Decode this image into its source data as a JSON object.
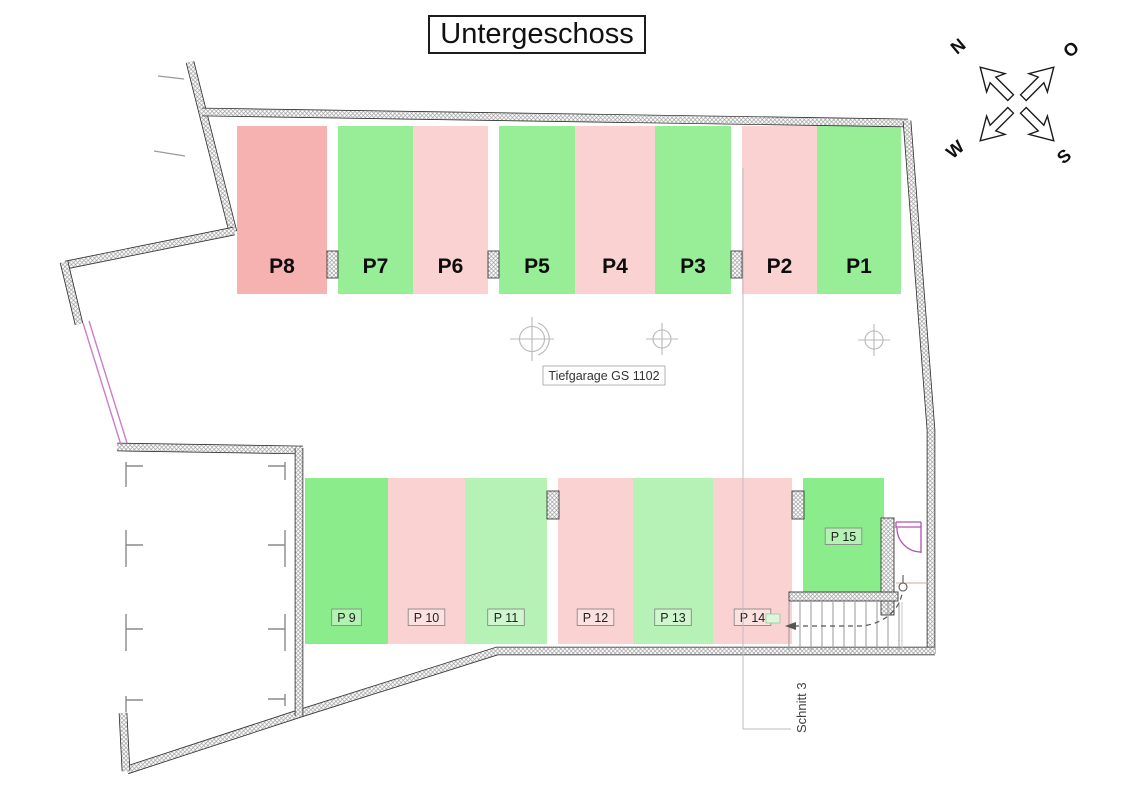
{
  "title": "Untergeschoss",
  "plan": {
    "garage_label": "Tiefgarage GS 1102",
    "section_label": "Schnitt 3"
  },
  "compass": {
    "north": "N",
    "east": "O",
    "west": "W",
    "south": "S"
  },
  "colors": {
    "pink": "#fbd2d2",
    "pink_dark": "#f6b1b1",
    "green": "#97ee97",
    "green_bright": "#8aec8a",
    "green_light": "#b6f2b6",
    "wall_line": "#9a9a9a",
    "magenta": "#b44fb4"
  },
  "parking": {
    "top_row": {
      "y": 126,
      "h": 168,
      "label_y": 273,
      "boxed": false,
      "spots": [
        {
          "label": "P8",
          "x": 237,
          "w": 90,
          "color": "pink_dark"
        },
        {
          "label": "P7",
          "x": 338,
          "w": 75,
          "color": "green"
        },
        {
          "label": "P6",
          "x": 413,
          "w": 75,
          "color": "pink"
        },
        {
          "label": "P5",
          "x": 499,
          "w": 76,
          "color": "green"
        },
        {
          "label": "P4",
          "x": 575,
          "w": 80,
          "color": "pink"
        },
        {
          "label": "P3",
          "x": 655,
          "w": 76,
          "color": "green"
        },
        {
          "label": "P2",
          "x": 742,
          "w": 75,
          "color": "pink"
        },
        {
          "label": "P1",
          "x": 817,
          "w": 84,
          "color": "green"
        }
      ]
    },
    "bottom_row": {
      "y": 478,
      "h": 166,
      "label_y": 622,
      "boxed": true,
      "spots": [
        {
          "label": "P 9",
          "x": 305,
          "w": 83,
          "color": "green_bright"
        },
        {
          "label": "P 10",
          "x": 388,
          "w": 77,
          "color": "pink"
        },
        {
          "label": "P 11",
          "x": 465,
          "w": 82,
          "color": "green_light"
        },
        {
          "label": "P 12",
          "x": 558,
          "w": 75,
          "color": "pink"
        },
        {
          "label": "P 13",
          "x": 633,
          "w": 80,
          "color": "green_light"
        },
        {
          "label": "P 14",
          "x": 713,
          "w": 79,
          "color": "pink"
        },
        {
          "label": "P 15",
          "x": 803,
          "w": 81,
          "color": "green_bright",
          "h": 119,
          "label_y": 541
        }
      ]
    }
  }
}
